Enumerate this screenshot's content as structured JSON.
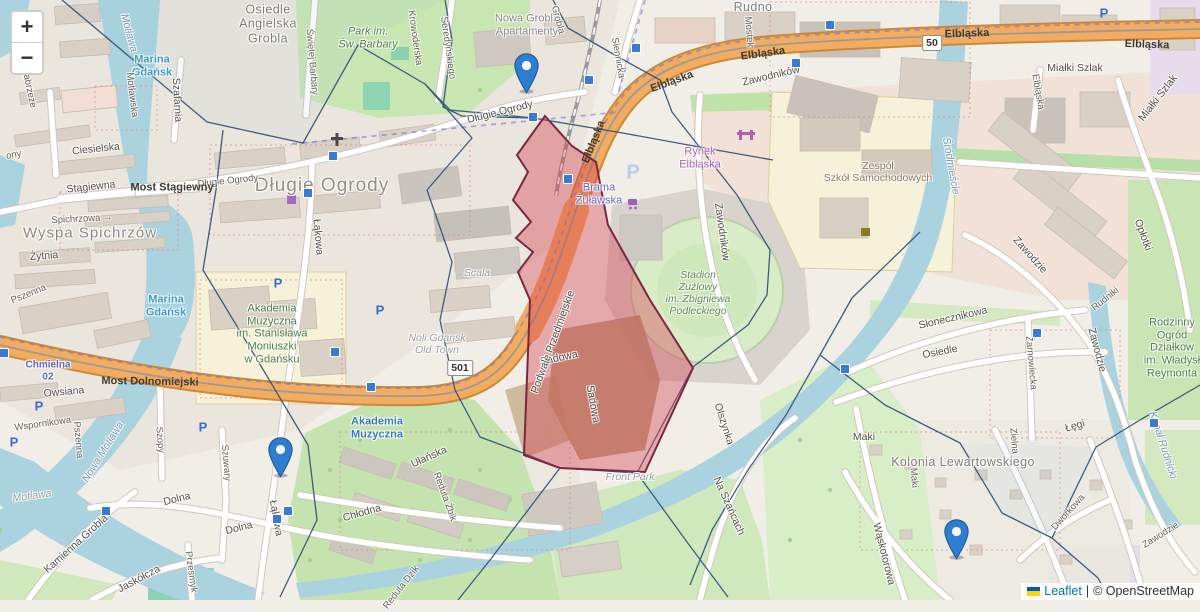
{
  "controls": {
    "zoom_in": "+",
    "zoom_out": "−"
  },
  "attribution": {
    "leaflet": "Leaflet",
    "separator": "|",
    "osm": "© OpenStreetMap",
    "flag_icon": "ukraine-flag-icon"
  },
  "route_badges": [
    {
      "text": "50",
      "x": 932,
      "y": 43
    },
    {
      "text": "501",
      "x": 460,
      "y": 368
    }
  ],
  "markers": [
    {
      "name": "marker-dlugie-ogrody",
      "tip_x": 526,
      "tip_y": 94
    },
    {
      "name": "marker-lakowa",
      "tip_x": 280,
      "tip_y": 478
    },
    {
      "name": "marker-kolonia",
      "tip_x": 956,
      "tip_y": 560
    }
  ],
  "marker_colors": {
    "fill": "#2F7DD1",
    "stroke": "#1E5D96",
    "dot": "#ffffff"
  },
  "overlay_colors": {
    "highlight_fill": "rgba(213,62,79,0.40)",
    "highlight_stroke": "#7a2740",
    "cell_stroke": "#2e4e73"
  },
  "transit_squares": [
    {
      "x": 533,
      "y": 117
    },
    {
      "x": 568,
      "y": 179
    },
    {
      "x": 589,
      "y": 80
    },
    {
      "x": 636,
      "y": 48
    },
    {
      "x": 796,
      "y": 63
    },
    {
      "x": 830,
      "y": 25
    },
    {
      "x": 333,
      "y": 156
    },
    {
      "x": 308,
      "y": 193
    },
    {
      "x": 335,
      "y": 352
    },
    {
      "x": 371,
      "y": 387
    },
    {
      "x": 4,
      "y": 353
    },
    {
      "x": 288,
      "y": 511
    },
    {
      "x": 277,
      "y": 519
    },
    {
      "x": 106,
      "y": 511
    },
    {
      "x": 1037,
      "y": 333
    },
    {
      "x": 845,
      "y": 369
    },
    {
      "x": 1154,
      "y": 423
    }
  ],
  "parking_icons": [
    {
      "x": 278,
      "y": 283,
      "big": false
    },
    {
      "x": 380,
      "y": 310,
      "big": false
    },
    {
      "x": 39,
      "y": 406,
      "big": false
    },
    {
      "x": 14,
      "y": 442,
      "big": false
    },
    {
      "x": 203,
      "y": 427,
      "big": false
    },
    {
      "x": 1104,
      "y": 13,
      "big": false
    },
    {
      "x": 633,
      "y": 173,
      "big": true
    }
  ],
  "labels": [
    {
      "text": "Osiedle\nAngielska\nGrobla",
      "x": 268,
      "y": 24,
      "rot": 0,
      "cls": "dist"
    },
    {
      "text": "Park im.\nŚw. Barbary",
      "x": 368,
      "y": 38,
      "rot": 0,
      "cls": "grn-park"
    },
    {
      "text": "Nowa Grobla\nApartamenty",
      "x": 527,
      "y": 25,
      "rot": 0,
      "cls": "dist-sm"
    },
    {
      "text": "Rudno",
      "x": 753,
      "y": 7,
      "rot": 0,
      "cls": "dist"
    },
    {
      "text": "Długie Ogrody",
      "x": 322,
      "y": 186,
      "rot": 0,
      "cls": "dist-lg"
    },
    {
      "text": "Wyspa Spichrzów",
      "x": 90,
      "y": 233,
      "rot": 0,
      "cls": "dist-md"
    },
    {
      "text": "Kolonia Lewartowskiego",
      "x": 963,
      "y": 462,
      "rot": 0,
      "cls": "dist"
    },
    {
      "text": "Rynek\nElbląska",
      "x": 700,
      "y": 158,
      "rot": 0,
      "cls": "poi-m"
    },
    {
      "text": "Zespół\nSzkół Samochodowych",
      "x": 878,
      "y": 172,
      "rot": 0,
      "cls": "edu"
    },
    {
      "text": "Stadion\nŻużlowy\nim. Zbigniewa\nPodleckiego",
      "x": 698,
      "y": 293,
      "rot": 0,
      "cls": "stad"
    },
    {
      "text": "Akademia\nMuzyczna\nim. Stanisława\nMoniuszki\nw Gdańsku",
      "x": 272,
      "y": 334,
      "rot": 0,
      "cls": "grn"
    },
    {
      "text": "Brama\nŻuławska",
      "x": 599,
      "y": 194,
      "rot": 0,
      "cls": "poi-v"
    },
    {
      "text": "Noli Gdansk\nOld Town",
      "x": 437,
      "y": 344,
      "rot": 0,
      "cls": "itg"
    },
    {
      "text": "Scala",
      "x": 477,
      "y": 273,
      "rot": 0,
      "cls": "itg"
    },
    {
      "text": "Front Park",
      "x": 630,
      "y": 477,
      "rot": 0,
      "cls": "itg"
    },
    {
      "text": "Rodzinny\nOgród\nDziałkow\nim. Władysł\nReymonta",
      "x": 1172,
      "y": 348,
      "rot": 0,
      "cls": "grn"
    },
    {
      "text": "Marina\nGdańsk",
      "x": 152,
      "y": 66,
      "rot": 0,
      "cls": "water-b"
    },
    {
      "text": "Marina\nGdańsk",
      "x": 166,
      "y": 306,
      "rot": 0,
      "cls": "water-b"
    },
    {
      "text": "Motława",
      "x": 129,
      "y": 33,
      "rot": 75,
      "cls": "water-i"
    },
    {
      "text": "Nowa Motława",
      "x": 103,
      "y": 452,
      "rot": -58,
      "cls": "water-i"
    },
    {
      "text": "Motława",
      "x": 32,
      "y": 496,
      "rot": -8,
      "cls": "itg"
    },
    {
      "text": "Śródmieście",
      "x": 951,
      "y": 166,
      "rot": 80,
      "cls": "water-i"
    },
    {
      "text": "Kanał Rudnicki",
      "x": 1163,
      "y": 445,
      "rot": 72,
      "cls": "water-i"
    },
    {
      "text": "Chmielna\n02",
      "x": 48,
      "y": 371,
      "rot": 0,
      "cls": "busroute"
    },
    {
      "text": "Szafarnia",
      "x": 177,
      "y": 100,
      "rot": 87,
      "cls": "st"
    },
    {
      "text": "Motławska",
      "x": 131,
      "y": 95,
      "rot": 83,
      "cls": "st-sm"
    },
    {
      "text": "Świętej Barbary",
      "x": 311,
      "y": 62,
      "rot": 85,
      "cls": "st-sm"
    },
    {
      "text": "Krowoderska",
      "x": 414,
      "y": 38,
      "rot": 82,
      "cls": "st-sm"
    },
    {
      "text": "Seredyńskiego",
      "x": 447,
      "y": 48,
      "rot": 82,
      "cls": "st-sm"
    },
    {
      "text": "Siennicka",
      "x": 617,
      "y": 58,
      "rot": 80,
      "cls": "st-sm"
    },
    {
      "text": "Grobla",
      "x": 557,
      "y": 20,
      "rot": 75,
      "cls": "st-sm"
    },
    {
      "text": "Mostek",
      "x": 748,
      "y": 32,
      "rot": 85,
      "cls": "st-sm"
    },
    {
      "text": "Zawodników",
      "x": 771,
      "y": 76,
      "rot": -13,
      "cls": "st"
    },
    {
      "text": "Zawodników",
      "x": 722,
      "y": 232,
      "rot": 82,
      "cls": "st"
    },
    {
      "text": "Długie Ogrody",
      "x": 228,
      "y": 182,
      "rot": -6,
      "cls": "st-sm"
    },
    {
      "text": "Długie Ogrody",
      "x": 500,
      "y": 112,
      "rot": -14,
      "cls": "st"
    },
    {
      "text": "Ciesielska",
      "x": 96,
      "y": 149,
      "rot": -6,
      "cls": "st"
    },
    {
      "text": "Stągiewna",
      "x": 91,
      "y": 187,
      "rot": -6,
      "cls": "st"
    },
    {
      "text": "Most Stągiewny",
      "x": 172,
      "y": 188,
      "rot": 0,
      "cls": "road-on"
    },
    {
      "text": "Spichrzowa →",
      "x": 82,
      "y": 220,
      "rot": -3,
      "cls": "st-sm"
    },
    {
      "text": "Żytnia",
      "x": 44,
      "y": 256,
      "rot": -4,
      "cls": "st"
    },
    {
      "text": "Pszenna",
      "x": 29,
      "y": 295,
      "rot": -22,
      "cls": "st-sm"
    },
    {
      "text": "Pszenna",
      "x": 77,
      "y": 440,
      "rot": 85,
      "cls": "st-sm"
    },
    {
      "text": "Owsiana",
      "x": 64,
      "y": 392,
      "rot": -5,
      "cls": "st"
    },
    {
      "text": "Wspornikowa",
      "x": 43,
      "y": 425,
      "rot": -8,
      "cls": "st-sm"
    },
    {
      "text": "Most Dolnomiejski",
      "x": 150,
      "y": 382,
      "rot": 1,
      "cls": "road-on"
    },
    {
      "text": "Szopy",
      "x": 159,
      "y": 440,
      "rot": 85,
      "cls": "st-sm"
    },
    {
      "text": "Szuwary",
      "x": 225,
      "y": 463,
      "rot": 85,
      "cls": "st-sm"
    },
    {
      "text": "Dolna",
      "x": 177,
      "y": 499,
      "rot": -14,
      "cls": "st"
    },
    {
      "text": "Dolna",
      "x": 239,
      "y": 528,
      "rot": -14,
      "cls": "st"
    },
    {
      "text": "Kamienna Grobla",
      "x": 76,
      "y": 544,
      "rot": -42,
      "cls": "st"
    },
    {
      "text": "Jaskółcza",
      "x": 139,
      "y": 579,
      "rot": -28,
      "cls": "st"
    },
    {
      "text": "Przesmyk",
      "x": 190,
      "y": 572,
      "rot": 82,
      "cls": "st-sm"
    },
    {
      "text": "Łąkowa",
      "x": 318,
      "y": 237,
      "rot": 85,
      "cls": "st"
    },
    {
      "text": "Łąkowa",
      "x": 276,
      "y": 518,
      "rot": 80,
      "cls": "st"
    },
    {
      "text": "Chłodna",
      "x": 362,
      "y": 513,
      "rot": -16,
      "cls": "st"
    },
    {
      "text": "Ułańska",
      "x": 429,
      "y": 457,
      "rot": -24,
      "cls": "st"
    },
    {
      "text": "Reduta Żbik",
      "x": 444,
      "y": 497,
      "rot": 70,
      "cls": "st-sm"
    },
    {
      "text": "Reduta Dzik",
      "x": 402,
      "y": 588,
      "rot": -52,
      "cls": "st-sm"
    },
    {
      "text": "Sadowa",
      "x": 559,
      "y": 358,
      "rot": -12,
      "cls": "st"
    },
    {
      "text": "Sadowa",
      "x": 593,
      "y": 404,
      "rot": 80,
      "cls": "st"
    },
    {
      "text": "Podwale Przedmiejskie",
      "x": 553,
      "y": 342,
      "rot": -70,
      "cls": "st"
    },
    {
      "text": "Elbląska",
      "x": 594,
      "y": 142,
      "rot": -68,
      "cls": "road-on"
    },
    {
      "text": "Elbląska",
      "x": 672,
      "y": 82,
      "rot": -20,
      "cls": "road-on"
    },
    {
      "text": "Elbląska",
      "x": 763,
      "y": 54,
      "rot": -8,
      "cls": "road-on"
    },
    {
      "text": "Elbląska",
      "x": 967,
      "y": 34,
      "rot": -2,
      "cls": "road-on"
    },
    {
      "text": "Elbląska",
      "x": 1147,
      "y": 45,
      "rot": 2,
      "cls": "road-on"
    },
    {
      "text": "Elbląska",
      "x": 1037,
      "y": 92,
      "rot": 80,
      "cls": "st-sm"
    },
    {
      "text": "Zawodzie",
      "x": 1030,
      "y": 255,
      "rot": 48,
      "cls": "st"
    },
    {
      "text": "Zawodzie",
      "x": 1097,
      "y": 350,
      "rot": 75,
      "cls": "st"
    },
    {
      "text": "Zawodzie",
      "x": 1161,
      "y": 536,
      "rot": -32,
      "cls": "st-sm"
    },
    {
      "text": "Opłotki",
      "x": 1143,
      "y": 235,
      "rot": 70,
      "cls": "st"
    },
    {
      "text": "Miałki Szlak",
      "x": 1075,
      "y": 68,
      "rot": 0,
      "cls": "st"
    },
    {
      "text": "Miałki Szlak",
      "x": 1158,
      "y": 98,
      "rot": -52,
      "cls": "st"
    },
    {
      "text": "Na Szańcach",
      "x": 729,
      "y": 506,
      "rot": 66,
      "cls": "st"
    },
    {
      "text": "Olszynka",
      "x": 724,
      "y": 424,
      "rot": 72,
      "cls": "st"
    },
    {
      "text": "Słonecznikowa",
      "x": 953,
      "y": 318,
      "rot": -13,
      "cls": "st"
    },
    {
      "text": "Osiedle",
      "x": 940,
      "y": 352,
      "rot": -11,
      "cls": "st"
    },
    {
      "text": "Żarnowiecka",
      "x": 1030,
      "y": 363,
      "rot": 85,
      "cls": "st-sm"
    },
    {
      "text": "Maki",
      "x": 864,
      "y": 437,
      "rot": 0,
      "cls": "st"
    },
    {
      "text": "Maki",
      "x": 913,
      "y": 478,
      "rot": 85,
      "cls": "st-sm"
    },
    {
      "text": "Zielna",
      "x": 1013,
      "y": 441,
      "rot": 85,
      "cls": "st-sm"
    },
    {
      "text": "Łęgi",
      "x": 1075,
      "y": 426,
      "rot": -16,
      "cls": "st"
    },
    {
      "text": "Wąskotorowa",
      "x": 884,
      "y": 554,
      "rot": 76,
      "cls": "st"
    },
    {
      "text": "Dworkowa",
      "x": 1069,
      "y": 513,
      "rot": -48,
      "cls": "st-sm"
    },
    {
      "text": "Rudniki",
      "x": 1106,
      "y": 300,
      "rot": -38,
      "cls": "st-sm"
    },
    {
      "text": "ony",
      "x": 14,
      "y": 156,
      "rot": -10,
      "cls": "st-sm"
    },
    {
      "text": "Nabrzeże",
      "x": 28,
      "y": 88,
      "rot": 78,
      "cls": "st-sm"
    },
    {
      "text": "Akademia\nMuzyczna",
      "x": 377,
      "y": 428,
      "rot": 0,
      "cls": "transit"
    }
  ]
}
